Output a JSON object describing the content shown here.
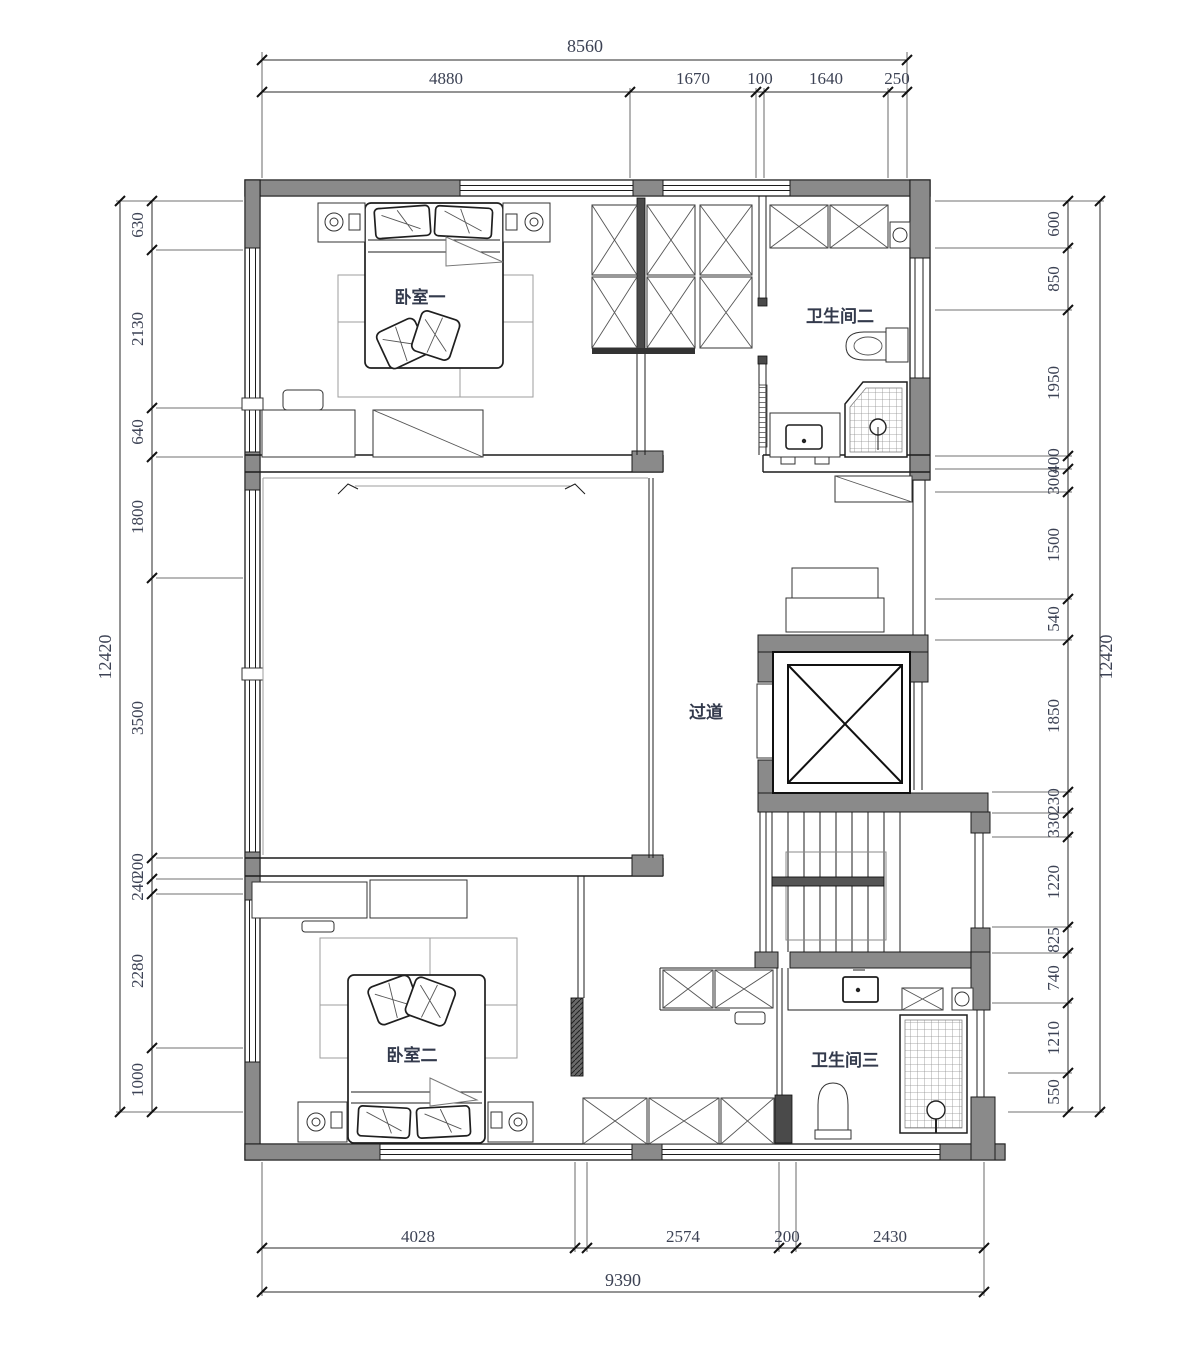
{
  "rooms": {
    "bedroom1": "卧室一",
    "bathroom2": "卫生间二",
    "hallway": "过道",
    "bedroom2": "卧室二",
    "bathroom3": "卫生间三"
  },
  "dimensions": {
    "top": {
      "total": "8560",
      "segments": [
        "4880",
        "1670",
        "100",
        "1640",
        "250"
      ]
    },
    "bottom": {
      "total": "9390",
      "segments": [
        "4028",
        "2574",
        "200",
        "2430"
      ]
    },
    "left": {
      "total": "12420",
      "segments": [
        "630",
        "2130",
        "640",
        "1800",
        "3500",
        "200",
        "240",
        "2280",
        "1000"
      ]
    },
    "right": {
      "total": "12420",
      "segments": [
        "600",
        "850",
        "1950",
        "400",
        "300",
        "1500",
        "540",
        "1850",
        "230",
        "330",
        "1220",
        "825",
        "740",
        "1210",
        "550"
      ]
    }
  },
  "colors": {
    "wall_gray": "#8a8a8a",
    "line_black": "#1c1c1c",
    "dim_text": "#3c4254",
    "room_text": "#333a4c"
  }
}
